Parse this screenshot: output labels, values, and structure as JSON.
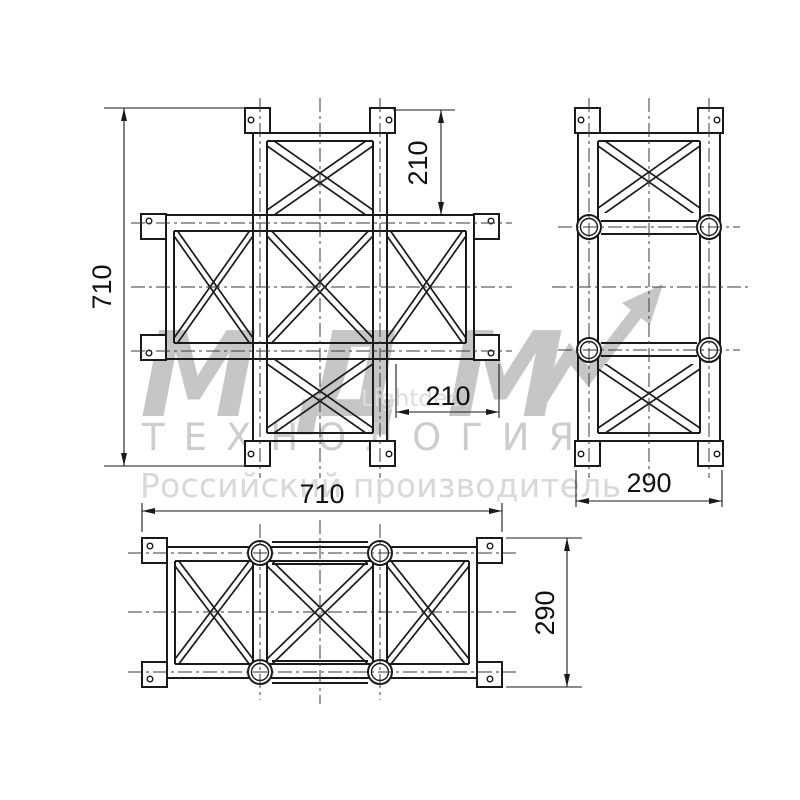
{
  "drawing": {
    "dimensions": {
      "front_height": "710",
      "front_arm_top": "210",
      "front_arm_bottom": "210",
      "side_width": "290",
      "bottom_width": "710",
      "bottom_height": "290"
    },
    "watermark": {
      "logo": "МДМ",
      "line1": "ТЕХНОЛОГИЯ",
      "line2": "Российский производитель",
      "small": "Lightdec"
    },
    "colors": {
      "line": "#1a1a1a",
      "watermark_gray": "#c6c6c6"
    }
  }
}
